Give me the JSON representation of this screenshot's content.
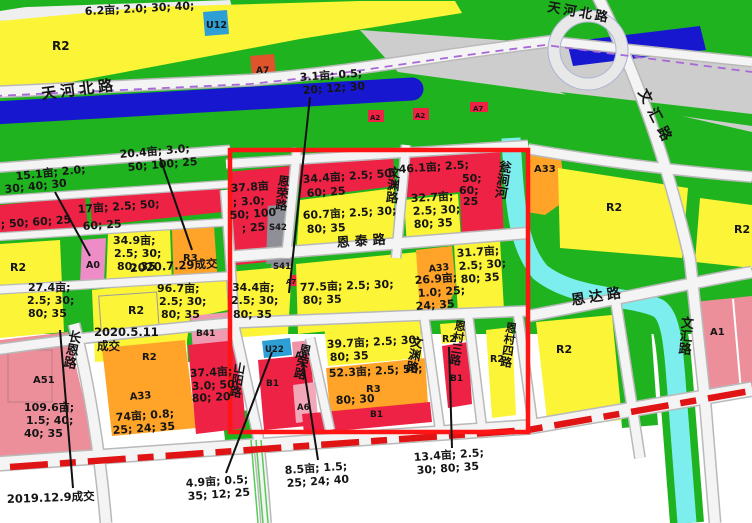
{
  "map_type": "land-use zoning map",
  "palette": {
    "residential_yellow": "#fbf437",
    "green_space": "#1fb41f",
    "commercial_red": "#ee2244",
    "mixed_orange": "#ffa428",
    "pink_salmon": "#ed8f9a",
    "pink_a0": "#ee8cc8",
    "pink_b41": "#ef9ab0",
    "utility_blue": "#2d9fd4",
    "gray_parcel": "#8f8f97",
    "canal_dark_blue": "#1717cf",
    "river_cyan": "#7deeee",
    "road_gray": "#cdcdcd",
    "highlight_rect_red": "#ff1515",
    "railway_red": "#e01414",
    "metro_purple": "#a868d8"
  },
  "roads": {
    "tianhebei_w": "天河北路",
    "tianhebei_e": "天河北路",
    "wenhui_ne": "文汇路",
    "wenhui_se": "文汇路",
    "wengjian_river": "瓮涧河",
    "entai": "恩泰路",
    "enda": "恩达路",
    "enrong_n": "恩荣路",
    "enrong_s": "恩荣路",
    "wenyuan_n": "文渊路",
    "wenyuan_s": "文渊路",
    "encun3": "恩村三路",
    "encun4": "恩村四路",
    "changen": "长恩路",
    "shanyang": "山阳路"
  },
  "parcels": {
    "r2": "R2",
    "u12": "U12",
    "a7": "A7",
    "a2": "A2",
    "a33": "A33",
    "a0": "A0",
    "r3": "R3",
    "b41": "B41",
    "a51": "A51",
    "s42": "S42",
    "s41": "S41",
    "u22": "U22",
    "a6": "A6",
    "b1": "B1",
    "a1": "A1"
  },
  "annotations": {
    "t62": [
      "6.2亩; 2.0; 30; 40;"
    ],
    "t31": [
      "3.1亩; 0.5;",
      "20; 12; 30"
    ],
    "t204": [
      "20.4亩; 3.0;",
      "50; 100; 25"
    ],
    "t151": [
      "15.1亩; 2.0;",
      "30; 40; 30"
    ],
    "tstw": [
      "; 50; 60; 25"
    ],
    "t17": [
      "17亩; 2.5; 50;",
      "60; 25"
    ],
    "t349": [
      "34.9亩;",
      "2.5; 30;",
      "80; 35"
    ],
    "t274": [
      "27.4亩;",
      "2.5; 30;",
      "80; 35"
    ],
    "t967": [
      "96.7亩;",
      "2.5; 30;",
      "80; 35"
    ],
    "t1096": [
      "109.6亩;",
      "1.5; 40;",
      "40; 35"
    ],
    "t74": [
      "74亩; 0.8;",
      "25; 24; 35"
    ],
    "t374": [
      "37.4亩;",
      "3.0; 50;",
      "80; 20"
    ],
    "t49": [
      "4.9亩; 0.5;",
      "35; 12; 25"
    ],
    "t85": [
      "8.5亩; 1.5;",
      "25; 24; 40"
    ],
    "t134": [
      "13.4亩; 2.5;",
      "30; 80; 35"
    ],
    "t378": [
      "37.8亩",
      "; 3.0;",
      "50; 100",
      "; 25"
    ],
    "t344n": [
      "34.4亩; 2.5; 50;",
      "60; 25"
    ],
    "t461": [
      "46.1亩; 2.5;",
      "50;",
      "60;",
      "25"
    ],
    "t607": [
      "60.7亩; 2.5; 30;",
      "80; 35"
    ],
    "t327": [
      "32.7亩;",
      "2.5; 30;",
      "80; 35"
    ],
    "t344s": [
      "34.4亩;",
      "2.5; 30;",
      "80; 35"
    ],
    "t775": [
      "77.5亩; 2.5; 30;",
      "80; 35"
    ],
    "t269": [
      "26.9亩;",
      "1.0; 25;",
      "24; 35"
    ],
    "t317": [
      "31.7亩;",
      "2.5; 30;",
      "80; 35"
    ],
    "t397": [
      "39.7亩; 2.5; 30;",
      "80; 35"
    ],
    "t523": [
      "52.3亩; 2.5; 50;",
      "80; 30"
    ]
  },
  "deals": {
    "d20200729": "2020.7.29成交",
    "d20200511a": "2020.5.11",
    "d20200511b": "成交",
    "d20191209": "2019.12.9成交"
  }
}
